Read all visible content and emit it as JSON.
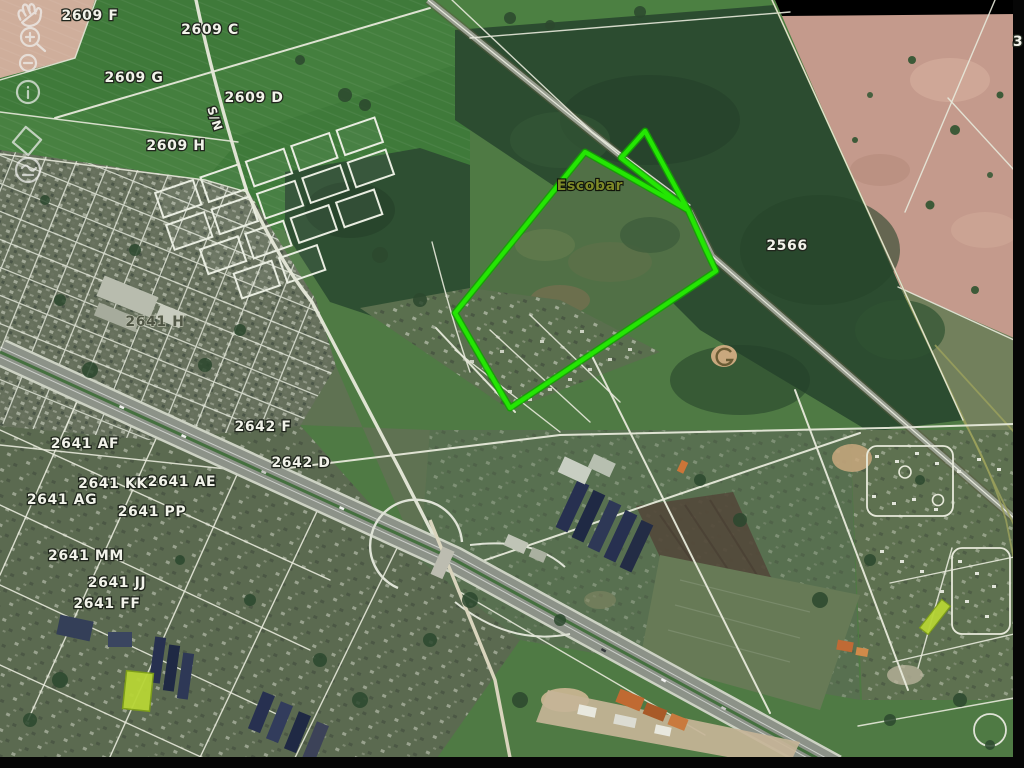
{
  "map": {
    "view": "satellite",
    "labels": [
      {
        "id": "parcel-2609-f",
        "text": "2609 F"
      },
      {
        "id": "parcel-2609-c",
        "text": "2609 C"
      },
      {
        "id": "parcel-2609-g",
        "text": "2609 G"
      },
      {
        "id": "parcel-2609-d",
        "text": "2609 D"
      },
      {
        "id": "parcel-2609-h",
        "text": "2609 H"
      },
      {
        "id": "road-sn",
        "text": "S/N"
      },
      {
        "id": "place-escobar",
        "text": "Escobar"
      },
      {
        "id": "parcel-2566",
        "text": "2566"
      },
      {
        "id": "parcel-2641-h",
        "text": "2641 H"
      },
      {
        "id": "parcel-2642-f",
        "text": "2642 F"
      },
      {
        "id": "parcel-2641-af",
        "text": "2641 AF"
      },
      {
        "id": "parcel-2642-d",
        "text": "2642 D"
      },
      {
        "id": "parcel-2641-kk",
        "text": "2641 KK"
      },
      {
        "id": "parcel-2641-ae",
        "text": "2641 AE"
      },
      {
        "id": "parcel-2641-ag",
        "text": "2641 AG"
      },
      {
        "id": "parcel-2641-pp",
        "text": "2641 PP"
      },
      {
        "id": "parcel-2641-mm",
        "text": "2641 MM"
      },
      {
        "id": "parcel-2641-jj",
        "text": "2641 JJ"
      },
      {
        "id": "parcel-2641-ff",
        "text": "2641 FF"
      },
      {
        "id": "edge-label-3",
        "text": "3"
      }
    ],
    "highlight": {
      "boundary_color": "#24e603",
      "parcel_fill": "#b7d535"
    }
  },
  "toolbar": {
    "icons": [
      {
        "name": "pan-hand"
      },
      {
        "name": "zoom-in"
      },
      {
        "name": "zoom-out"
      },
      {
        "name": "info"
      },
      {
        "name": "diamond-marker"
      },
      {
        "name": "loop-marker"
      }
    ]
  }
}
